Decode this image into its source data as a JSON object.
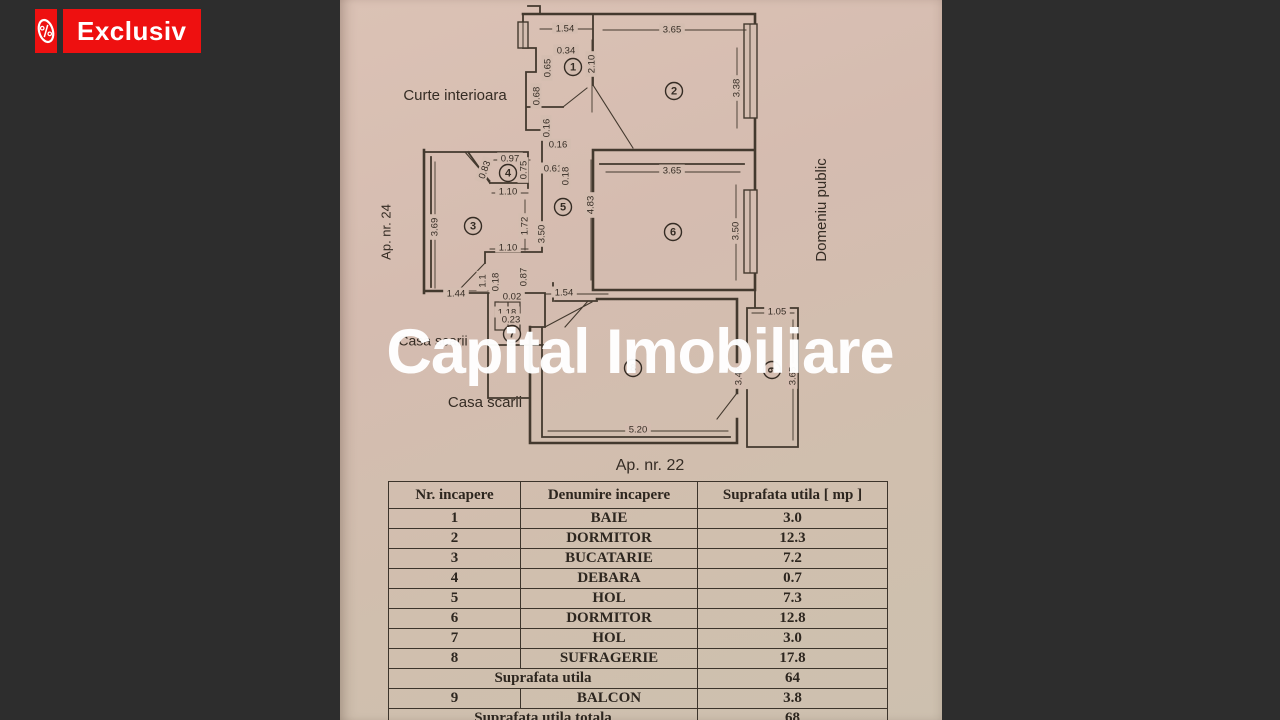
{
  "badge": {
    "label": "Exclusiv",
    "icon": "percent-tag-icon",
    "bg_color": "#ee1010",
    "fg_color": "#ffffff"
  },
  "watermark": {
    "text": "Capital Imobiliare",
    "color": "#ffffff"
  },
  "photo": {
    "paper_color": "#d4bdb0",
    "line_color": "#43392e",
    "text_color": "#352c24"
  },
  "plan": {
    "area_labels": [
      {
        "text": "Curte interioara",
        "x": 115,
        "y": 96,
        "rot": 0,
        "size": 15
      },
      {
        "text": "Ap. nr. 24",
        "x": 47,
        "y": 232,
        "rot": -90,
        "size": 13
      },
      {
        "text": "Domeniu public",
        "x": 482,
        "y": 210,
        "rot": -90,
        "size": 15
      },
      {
        "text": "Casa scarii",
        "x": 93,
        "y": 342,
        "rot": 0,
        "size": 14
      },
      {
        "text": "Casa scarii",
        "x": 145,
        "y": 403,
        "rot": 0,
        "size": 15
      },
      {
        "text": "Ap. nr. 22",
        "x": 310,
        "y": 466,
        "rot": 0,
        "size": 16
      }
    ],
    "rooms": [
      {
        "n": "1",
        "x": 233,
        "y": 67,
        "rot": 0
      },
      {
        "n": "2",
        "x": 334,
        "y": 91,
        "rot": 0
      },
      {
        "n": "3",
        "x": 133,
        "y": 226,
        "rot": 0
      },
      {
        "n": "4",
        "x": 168,
        "y": 173,
        "rot": 0
      },
      {
        "n": "5",
        "x": 223,
        "y": 207,
        "rot": 0
      },
      {
        "n": "6",
        "x": 333,
        "y": 232,
        "rot": 0
      },
      {
        "n": "7",
        "x": 172,
        "y": 334,
        "rot": 0
      },
      {
        "n": "8",
        "x": 293,
        "y": 368,
        "rot": 0
      },
      {
        "n": "9",
        "x": 432,
        "y": 370,
        "rot": -90
      }
    ],
    "dims": [
      {
        "t": "1.54",
        "x": 225,
        "y": 29,
        "r": 0
      },
      {
        "t": "3.65",
        "x": 332,
        "y": 30,
        "r": 0
      },
      {
        "t": "0.34",
        "x": 226,
        "y": 51,
        "r": 0
      },
      {
        "t": "0.65",
        "x": 208,
        "y": 68,
        "r": -90
      },
      {
        "t": "2.10",
        "x": 252,
        "y": 64,
        "r": -90
      },
      {
        "t": "0.68",
        "x": 197,
        "y": 96,
        "r": -90
      },
      {
        "t": "3.38",
        "x": 397,
        "y": 88,
        "r": -90
      },
      {
        "t": "0.16",
        "x": 207,
        "y": 128,
        "r": -90
      },
      {
        "t": "0.16",
        "x": 218,
        "y": 145,
        "r": 0
      },
      {
        "t": "0.97",
        "x": 170,
        "y": 159,
        "r": 0
      },
      {
        "t": "0.83",
        "x": 145,
        "y": 170,
        "r": -70
      },
      {
        "t": "0.75",
        "x": 184,
        "y": 170,
        "r": -90
      },
      {
        "t": "0.61",
        "x": 213,
        "y": 169,
        "r": 0
      },
      {
        "t": "0.18",
        "x": 226,
        "y": 176,
        "r": -90
      },
      {
        "t": "1.10",
        "x": 168,
        "y": 192,
        "r": 0
      },
      {
        "t": "3.69",
        "x": 95,
        "y": 227,
        "r": -90
      },
      {
        "t": "1.72",
        "x": 185,
        "y": 226,
        "r": -90
      },
      {
        "t": "3.50",
        "x": 202,
        "y": 234,
        "r": -90
      },
      {
        "t": "4.83",
        "x": 251,
        "y": 205,
        "r": -90
      },
      {
        "t": "3.65",
        "x": 332,
        "y": 171,
        "r": 0
      },
      {
        "t": "3.50",
        "x": 396,
        "y": 231,
        "r": -90
      },
      {
        "t": "1.10",
        "x": 168,
        "y": 248,
        "r": 0
      },
      {
        "t": "1.1",
        "x": 143,
        "y": 281,
        "r": -90
      },
      {
        "t": "0.18",
        "x": 156,
        "y": 282,
        "r": -90
      },
      {
        "t": "0.87",
        "x": 184,
        "y": 277,
        "r": -90
      },
      {
        "t": "1.44",
        "x": 116,
        "y": 294,
        "r": 0
      },
      {
        "t": "0.02",
        "x": 172,
        "y": 297,
        "r": 0
      },
      {
        "t": "1.54",
        "x": 224,
        "y": 293,
        "r": 0
      },
      {
        "t": "1.18",
        "x": 167,
        "y": 313,
        "r": 0
      },
      {
        "t": "0.23",
        "x": 171,
        "y": 320,
        "r": 0
      },
      {
        "t": "5.20",
        "x": 298,
        "y": 430,
        "r": 0
      },
      {
        "t": "1.05",
        "x": 437,
        "y": 312,
        "r": 0
      },
      {
        "t": "3.65",
        "x": 453,
        "y": 376,
        "r": -90
      },
      {
        "t": "3.43",
        "x": 399,
        "y": 376,
        "r": -90
      }
    ]
  },
  "table": {
    "headers": [
      "Nr. incapere",
      "Denumire  incapere",
      "Suprafata utila [ mp ]"
    ],
    "rows": [
      [
        "1",
        "BAIE",
        "3.0"
      ],
      [
        "2",
        "DORMITOR",
        "12.3"
      ],
      [
        "3",
        "BUCATARIE",
        "7.2"
      ],
      [
        "4",
        "DEBARA",
        "0.7"
      ],
      [
        "5",
        "HOL",
        "7.3"
      ],
      [
        "6",
        "DORMITOR",
        "12.8"
      ],
      [
        "7",
        "HOL",
        "3.0"
      ],
      [
        "8",
        "SUFRAGERIE",
        "17.8"
      ]
    ],
    "subtotal": {
      "label": "Suprafata utila",
      "value": "64"
    },
    "balcony_row": [
      "9",
      "BALCON",
      "3.8"
    ],
    "total": {
      "label": "Suprafata utila totala",
      "value": "68"
    }
  }
}
